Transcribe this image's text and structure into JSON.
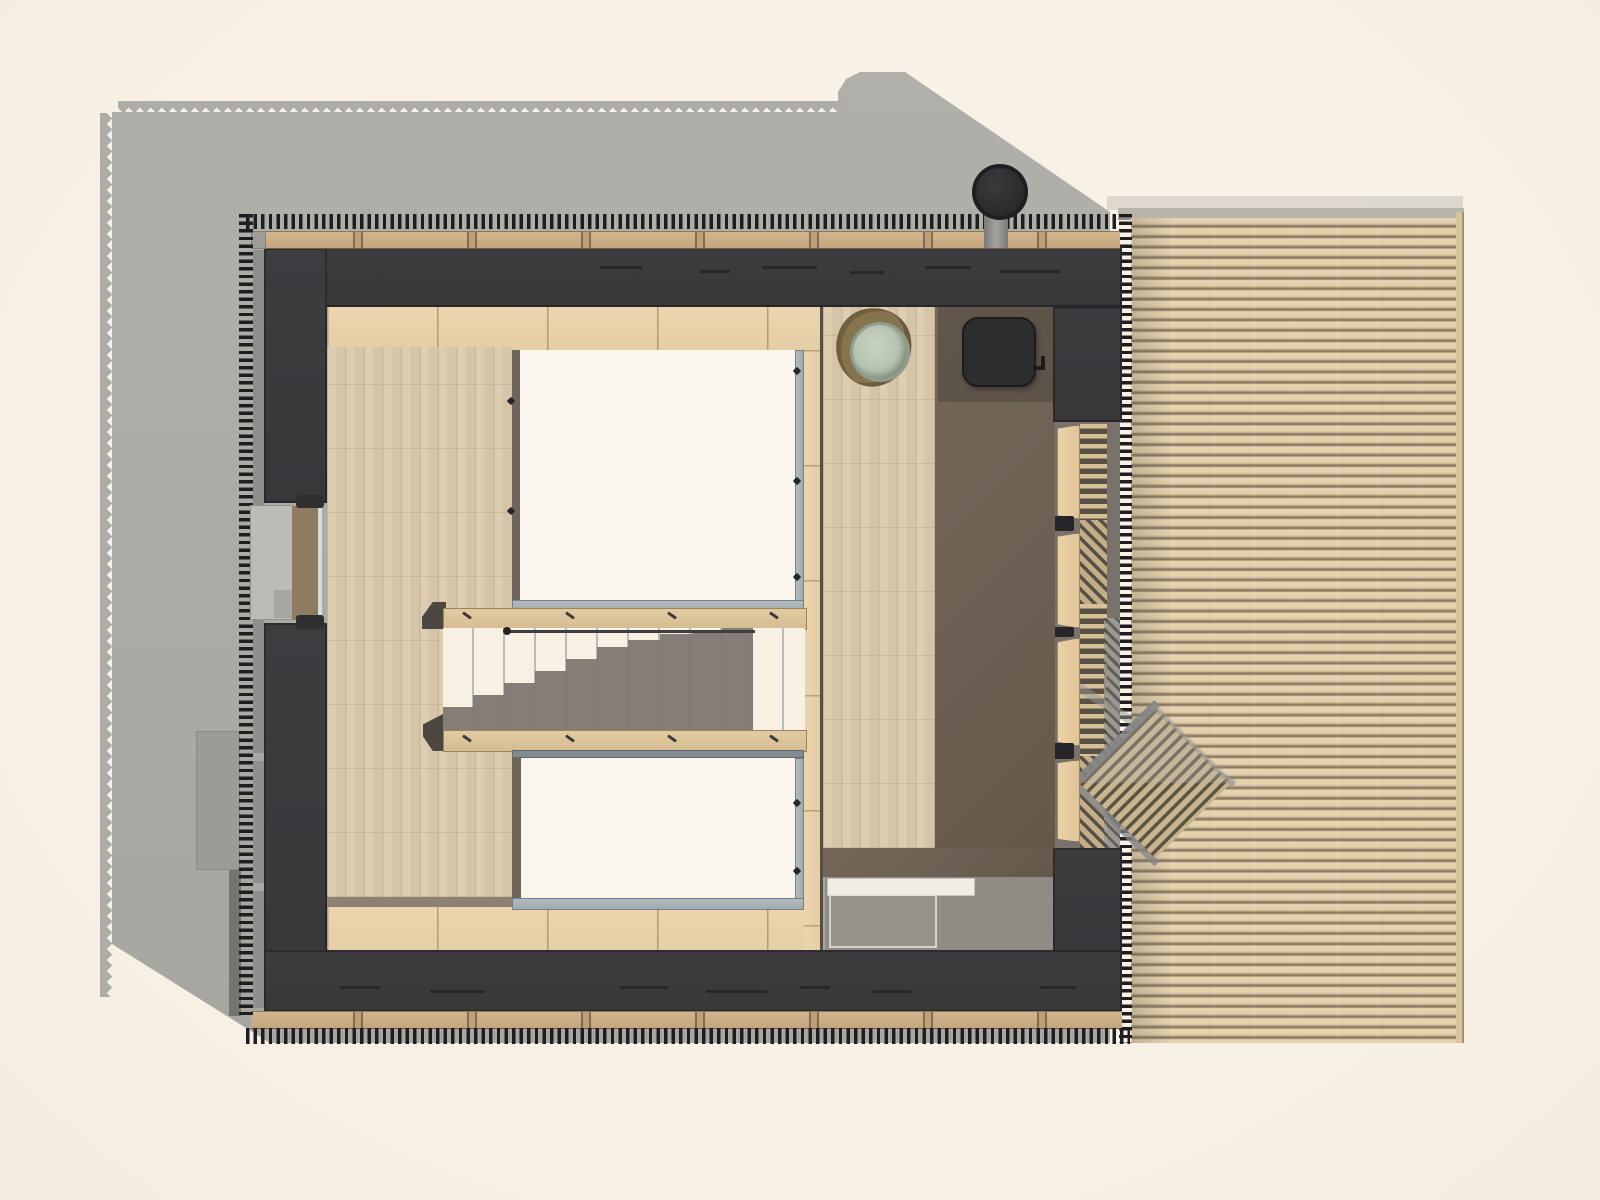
{
  "document": {
    "kind": "architectural floor plan rendering",
    "view": "top-down / roof-level plan",
    "text_content": "none visible"
  },
  "palette": {
    "paper_background": "#f8f2e7",
    "cast_shadow": "#abaaa5",
    "wall_charcoal": "#3b3b3e",
    "batten_tick": "#1e1e20",
    "timber_rail": "#c9ae85",
    "beige_floor_band": "#e8d1aa",
    "wood_plank_floor": "#dbcbae",
    "dark_brown_floor": "#6b5f53",
    "bath_gray_floor": "#908c85",
    "void_opening_white": "#fbf6ec",
    "glass_balustrade": "#a9b2b8",
    "stair_stringer": "#ddc59d",
    "stair_dark_steps": "#7e7770",
    "deck_slat": "#e4d1af",
    "deck_groove": "#8e7d63",
    "stove_black": "#2d2d30",
    "basin_green": "#b4c0ae",
    "lattice_dark": "#5d5443"
  },
  "parts": {
    "site_shadow": {
      "label": "building cast shadow with serrated roof-batten edge"
    },
    "platform": {
      "label": "exterior step platform"
    },
    "deck": {
      "label": "timber slat deck"
    },
    "deck_battens": {
      "label": "deck edge battens"
    },
    "building": {
      "label": "charcoal building envelope"
    },
    "roof_battens": {
      "label": "roof batten ticks"
    },
    "eave_rail": {
      "label": "timber eave rail"
    },
    "window": {
      "label": "west window with deep sill"
    },
    "bedroom_floor": {
      "label": "wood plank floor (west room)"
    },
    "east_floor": {
      "label": "wood plank floor (east room)"
    },
    "dark_zone": {
      "label": "shadowed floor zone with hearth"
    },
    "bath_zone": {
      "label": "gray floor zone with bench and glass screen"
    },
    "void1": {
      "label": "double-height void with glass balustrade (north)"
    },
    "void2": {
      "label": "double-height void with glass balustrade (south)"
    },
    "stair": {
      "label": "staircase with stringers and descending steps"
    },
    "stove": {
      "label": "wood stove"
    },
    "chimney": {
      "label": "chimney flue"
    },
    "basin": {
      "label": "wash basin on timber stand"
    },
    "lattice": {
      "label": "diamond grating gangway on deck"
    },
    "shelves": {
      "label": "east wall shelving / ladder strip"
    }
  },
  "metrics": {
    "canvas": {
      "width": 1600,
      "height": 1200
    },
    "batten_pitch_px": 7.6,
    "deck_slat_pitch_px": 10.4,
    "stair_tread_pitch_px": 31,
    "plank_width_px": 18.5
  }
}
